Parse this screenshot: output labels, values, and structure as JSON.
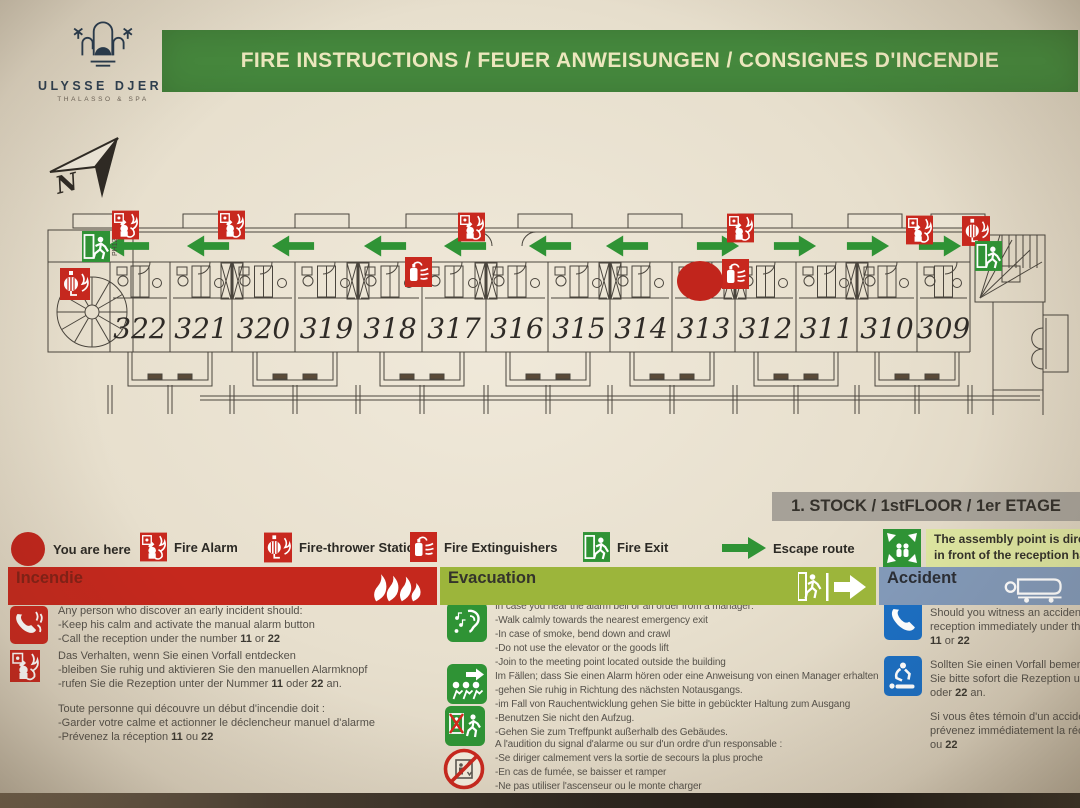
{
  "header": {
    "brand_name": "ULYSSE DJERBA",
    "brand_tagline": "THALASSO & SPA",
    "title": "FIRE INSTRUCTIONS / FEUER ANWEISUNGEN / CONSIGNES D'INCENDIE"
  },
  "floor_label": "1. STOCK / 1stFLOOR / 1er ETAGE",
  "plan": {
    "north_label": "N",
    "stair_label": "PH12",
    "rooms": [
      "322",
      "321",
      "320",
      "319",
      "318",
      "317",
      "316",
      "315",
      "314",
      "313",
      "312",
      "311",
      "310",
      "309"
    ],
    "you_are_here_room": "313",
    "escape_arrows": [
      "left",
      "left",
      "left",
      "left",
      "left",
      "left",
      "left",
      "right",
      "right",
      "right",
      "right"
    ]
  },
  "legend": {
    "items": [
      {
        "icon": "you-are-here-marker",
        "label": "You are here"
      },
      {
        "icon": "fire-alarm-icon",
        "label": "Fire Alarm"
      },
      {
        "icon": "fire-thrower-station-icon",
        "label": "Fire-thrower Station"
      },
      {
        "icon": "fire-extinguishers-icon",
        "label": "Fire Extinguishers"
      },
      {
        "icon": "fire-exit-icon",
        "label": "Fire Exit"
      },
      {
        "icon": "escape-route-icon",
        "label": "Escape route"
      },
      {
        "icon": "assembly-point-icon",
        "label": "The assembly point is directly in front of the reception hall"
      }
    ],
    "assembly_note_line1": "The assembly point is directly",
    "assembly_note_line2": "in front of the reception hall"
  },
  "sections": {
    "incendie": {
      "title": "Incendie",
      "blocks": [
        {
          "icons": [
            "phone-fire-icon"
          ],
          "lines": [
            "Any person who discover an early incident should:",
            "-Keep his calm and activate the manual alarm button",
            "-Call the reception under the number 11 or 22"
          ]
        },
        {
          "icons": [
            "alarm-button-icon"
          ],
          "lines": [
            "Das Verhalten, wenn Sie einen Vorfall entdecken",
            "-bleiben Sie ruhig und aktivieren Sie den manuellen Alarmknopf",
            "-rufen Sie die Rezeption unter der Nummer 11 oder 22 an."
          ]
        },
        {
          "icons": [],
          "lines": [
            "Toute personne qui découvre un début d'incendie doit :",
            "-Garder votre calme et actionner le déclencheur manuel d'alarme",
            "-Prévenez la réception 11 ou 22"
          ]
        }
      ]
    },
    "evacuation": {
      "title": "Evacuation",
      "blocks": [
        {
          "icons": [
            "ear-alarm-icon"
          ],
          "lines": [
            "In case you hear the alarm bell or an order from a manager:",
            "-Walk calmly towards the nearest emergency exit",
            "-In case of smoke, bend down and crawl",
            "-Do not use the elevator or the goods lift",
            "-Join to the meeting point located outside the building"
          ]
        },
        {
          "icons": [
            "evacuate-direction-icon",
            "no-elevator-walk-icon"
          ],
          "lines": [
            "Im Fällen; dass Sie einen Alarm hören oder eine Anweisung von einen Manager erhalten",
            "-gehen Sie ruhig in Richtung des nächsten Notausgangs.",
            "-im Fall von Rauchentwicklung gehen Sie bitte in gebückter Haltung zum Ausgang",
            "-Benutzen Sie nicht den Aufzug.",
            "-Gehen Sie zum Treffpunkt außerhalb des Gebäudes."
          ]
        },
        {
          "icons": [
            "no-elevator-prohibited-icon"
          ],
          "lines": [
            "A l'audition du signal d'alarme ou sur d'un ordre d'un responsable :",
            "-Se diriger calmement vers la sortie de secours la plus proche",
            "-En cas de fumée, se baisser et ramper",
            "-Ne pas utiliser l'ascenseur ou le monte charger",
            "-Rejoindre le point de rassemblement situé à l'extérieur du bâtiment"
          ]
        }
      ]
    },
    "accident": {
      "title": "Accident",
      "blocks": [
        {
          "icons": [
            "phone-call-icon"
          ],
          "lines": [
            "Should you witness an accident, call the",
            "reception immediately under the number",
            "11 or 22"
          ]
        },
        {
          "icons": [
            "first-aid-accident-icon"
          ],
          "lines": [
            "Sollten Sie einen Vorfall bemerken; rufen",
            "Sie bitte sofort die Rezeption unter 11",
            "oder 22 an."
          ]
        },
        {
          "icons": [],
          "lines": [
            "Si vous êtes témoin d'un accident,",
            "prévenez immédiatement la réception 11",
            "ou 22"
          ]
        }
      ]
    }
  },
  "colors": {
    "banner_green": "#45883d",
    "safety_red": "#c8281e",
    "exit_green": "#2f9335",
    "evacuation_band": "#9cb53b",
    "accident_band": "#8299b8",
    "info_blue": "#1b6ec2",
    "floorbar_gray": "#a6a198",
    "assembly_note_bg": "#dce49f"
  }
}
